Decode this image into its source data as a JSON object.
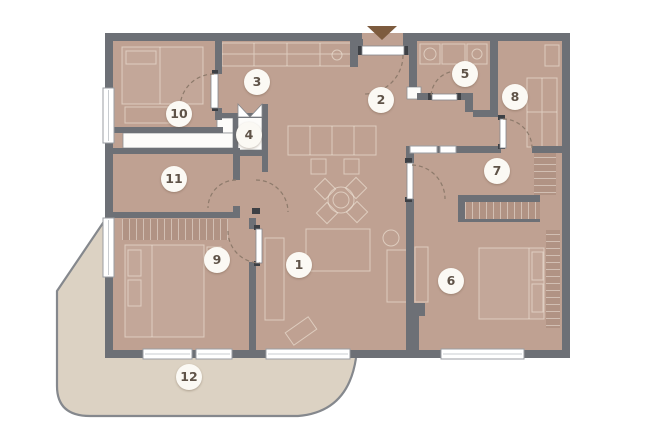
{
  "colors": {
    "floor": "#bfa192",
    "wall": "#6d7076",
    "terrace": "#dcd2c3",
    "terrace_edge": "#85888d",
    "wardrobe": "#b19384",
    "door_arc": "#8d7a6b",
    "window_frame": "#9b9ea3",
    "furniture_line": "#f0e6da",
    "label_bg": "#fbf9f4",
    "label_text": "#5f5348",
    "arrow": "#7d5b3e"
  },
  "icons": {
    "entry_arrow": "triangle-down"
  },
  "rooms": [
    {
      "number": "1"
    },
    {
      "number": "2"
    },
    {
      "number": "3"
    },
    {
      "number": "4"
    },
    {
      "number": "5"
    },
    {
      "number": "6"
    },
    {
      "number": "7"
    },
    {
      "number": "8"
    },
    {
      "number": "9"
    },
    {
      "number": "10"
    },
    {
      "number": "11"
    },
    {
      "number": "12"
    }
  ]
}
